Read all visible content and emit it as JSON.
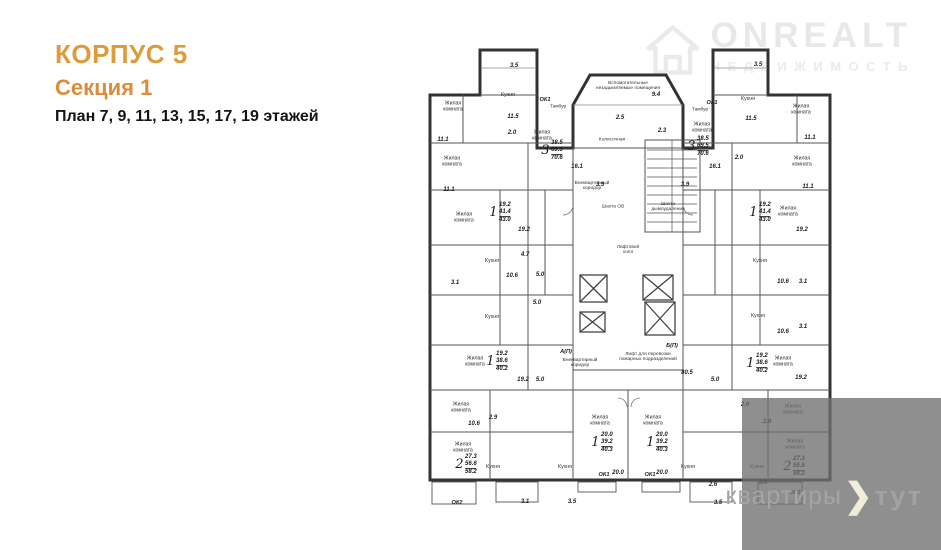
{
  "title": {
    "line1": "КОРПУС 5",
    "line2": "Секция 1",
    "line3": "План 7, 9, 11, 13, 15, 17, 19 этажей"
  },
  "watermark_top": {
    "brand": "ONREALT",
    "sub": "НЕДВИЖИМОСТЬ"
  },
  "watermark_bottom": {
    "word1": "квартиры",
    "word2": "тут"
  },
  "colors": {
    "title_orange": "#DD9B3B",
    "subtitle_orange": "#DC8C3A",
    "wall_dark": "#333333",
    "watermark_gray": "#d6d6d6",
    "box_gray": "#707070",
    "chevron_cream": "#F2ECDA"
  },
  "plan": {
    "labels": [
      {
        "t": "Жилая\nкомната",
        "x": 453,
        "y": 107,
        "s": "r"
      },
      {
        "t": "Жилая\nкомната",
        "x": 452,
        "y": 162,
        "s": "r"
      },
      {
        "t": "Жилая\nкомната",
        "x": 464,
        "y": 218,
        "s": "r"
      },
      {
        "t": "Жилая\nкомната",
        "x": 475,
        "y": 362,
        "s": "r"
      },
      {
        "t": "Жилая\nкомната",
        "x": 461,
        "y": 408,
        "s": "r"
      },
      {
        "t": "Жилая\nкомната",
        "x": 463,
        "y": 448,
        "s": "r"
      },
      {
        "t": "Жилая\nкомната",
        "x": 542,
        "y": 136,
        "s": "r"
      },
      {
        "t": "Жилая\nкомната",
        "x": 600,
        "y": 421,
        "s": "r"
      },
      {
        "t": "Жилая\nкомната",
        "x": 653,
        "y": 421,
        "s": "r"
      },
      {
        "t": "Жилая\nкомната",
        "x": 702,
        "y": 128,
        "s": "r"
      },
      {
        "t": "Жилая\nкомната",
        "x": 788,
        "y": 212,
        "s": "r"
      },
      {
        "t": "Жилая\nкомната",
        "x": 783,
        "y": 362,
        "s": "r"
      },
      {
        "t": "Жилая\nкомната",
        "x": 793,
        "y": 410,
        "s": "r"
      },
      {
        "t": "Жилая\nкомната",
        "x": 795,
        "y": 445,
        "s": "r"
      },
      {
        "t": "Жилая\nкомната",
        "x": 801,
        "y": 110,
        "s": "r"
      },
      {
        "t": "Жилая\nкомната",
        "x": 802,
        "y": 162,
        "s": "r"
      },
      {
        "t": "Кухня",
        "x": 508,
        "y": 96,
        "s": "k"
      },
      {
        "t": "Кухня",
        "x": 748,
        "y": 100,
        "s": "k"
      },
      {
        "t": "Кухня",
        "x": 492,
        "y": 262,
        "s": "k"
      },
      {
        "t": "Кухня",
        "x": 760,
        "y": 262,
        "s": "k"
      },
      {
        "t": "Кухня",
        "x": 492,
        "y": 318,
        "s": "k"
      },
      {
        "t": "Кухня",
        "x": 758,
        "y": 317,
        "s": "k"
      },
      {
        "t": "Кухня",
        "x": 493,
        "y": 468,
        "s": "k"
      },
      {
        "t": "Кухня",
        "x": 565,
        "y": 468,
        "s": "k"
      },
      {
        "t": "Кухня",
        "x": 688,
        "y": 468,
        "s": "k"
      },
      {
        "t": "Кухня",
        "x": 757,
        "y": 468,
        "s": "k"
      },
      {
        "t": "Тамбур",
        "x": 558,
        "y": 107,
        "s": "t"
      },
      {
        "t": "Тамбур",
        "x": 700,
        "y": 110,
        "s": "t"
      },
      {
        "t": "Колясочная",
        "x": 612,
        "y": 140,
        "s": "t"
      },
      {
        "t": "Внеквартирный\nкоридор",
        "x": 592,
        "y": 186,
        "s": "t"
      },
      {
        "t": "Внеквартирный\nкоридор",
        "x": 580,
        "y": 363,
        "s": "t"
      },
      {
        "t": "Лифтовой\nхолл",
        "x": 628,
        "y": 250,
        "s": "t"
      },
      {
        "t": "Шахта ОВ",
        "x": 613,
        "y": 207,
        "s": "t"
      },
      {
        "t": "Шахта\nдымоудаления",
        "x": 668,
        "y": 207,
        "s": "t"
      },
      {
        "t": "Вспомогательные\nнезадымляемые помещения",
        "x": 628,
        "y": 86,
        "s": "t"
      },
      {
        "t": "Лифт для перевозки\nпожарных подразделений",
        "x": 648,
        "y": 357,
        "s": "t"
      },
      {
        "t": "А(П)",
        "x": 566,
        "y": 352,
        "s": "ok"
      },
      {
        "t": "Б(П)",
        "x": 672,
        "y": 346,
        "s": "ok"
      },
      {
        "t": "ОК1",
        "x": 545,
        "y": 100,
        "s": "ok"
      },
      {
        "t": "ОК1",
        "x": 712,
        "y": 103,
        "s": "ok"
      },
      {
        "t": "ОК1",
        "x": 604,
        "y": 475,
        "s": "ok"
      },
      {
        "t": "ОК1",
        "x": 650,
        "y": 475,
        "s": "ok"
      },
      {
        "t": "ОК2",
        "x": 457,
        "y": 503,
        "s": "ok"
      },
      {
        "t": "ОК2",
        "x": 795,
        "y": 493,
        "s": "ok"
      },
      {
        "t": "11.1",
        "x": 443,
        "y": 140,
        "s": "a"
      },
      {
        "t": "11.1",
        "x": 449,
        "y": 190,
        "s": "a"
      },
      {
        "t": "11.5",
        "x": 513,
        "y": 117,
        "s": "a"
      },
      {
        "t": "3.5",
        "x": 514,
        "y": 66,
        "s": "a"
      },
      {
        "t": "3.5",
        "x": 758,
        "y": 65,
        "s": "a"
      },
      {
        "t": "11.5",
        "x": 751,
        "y": 119,
        "s": "a"
      },
      {
        "t": "2.0",
        "x": 512,
        "y": 133,
        "s": "a"
      },
      {
        "t": "2.0",
        "x": 739,
        "y": 158,
        "s": "a"
      },
      {
        "t": "9.4",
        "x": 656,
        "y": 95,
        "s": "a"
      },
      {
        "t": "2.5",
        "x": 620,
        "y": 118,
        "s": "a"
      },
      {
        "t": "2.3",
        "x": 662,
        "y": 131,
        "s": "a"
      },
      {
        "t": "16.1",
        "x": 577,
        "y": 167,
        "s": "a"
      },
      {
        "t": "16.1",
        "x": 715,
        "y": 167,
        "s": "a"
      },
      {
        "t": "3.9",
        "x": 600,
        "y": 185,
        "s": "a"
      },
      {
        "t": "3.9",
        "x": 685,
        "y": 185,
        "s": "a"
      },
      {
        "t": "19.2",
        "x": 524,
        "y": 230,
        "s": "a"
      },
      {
        "t": "19.2",
        "x": 802,
        "y": 230,
        "s": "a"
      },
      {
        "t": "19.2",
        "x": 523,
        "y": 380,
        "s": "a"
      },
      {
        "t": "19.2",
        "x": 801,
        "y": 378,
        "s": "a"
      },
      {
        "t": "10.6",
        "x": 512,
        "y": 276,
        "s": "a"
      },
      {
        "t": "10.6",
        "x": 783,
        "y": 282,
        "s": "a"
      },
      {
        "t": "10.6",
        "x": 474,
        "y": 424,
        "s": "a"
      },
      {
        "t": "10.6",
        "x": 783,
        "y": 332,
        "s": "a"
      },
      {
        "t": "4.7",
        "x": 525,
        "y": 255,
        "s": "a"
      },
      {
        "t": "5.0",
        "x": 540,
        "y": 275,
        "s": "a"
      },
      {
        "t": "5.0",
        "x": 537,
        "y": 303,
        "s": "a"
      },
      {
        "t": "5.0",
        "x": 540,
        "y": 380,
        "s": "a"
      },
      {
        "t": "5.0",
        "x": 715,
        "y": 380,
        "s": "a"
      },
      {
        "t": "3.1",
        "x": 455,
        "y": 283,
        "s": "a"
      },
      {
        "t": "3.1",
        "x": 803,
        "y": 282,
        "s": "a"
      },
      {
        "t": "3.1",
        "x": 803,
        "y": 327,
        "s": "a"
      },
      {
        "t": "11.1",
        "x": 810,
        "y": 138,
        "s": "a"
      },
      {
        "t": "11.1",
        "x": 808,
        "y": 187,
        "s": "a"
      },
      {
        "t": "2.9",
        "x": 493,
        "y": 418,
        "s": "a"
      },
      {
        "t": "2.9",
        "x": 767,
        "y": 422,
        "s": "a"
      },
      {
        "t": "2.6",
        "x": 745,
        "y": 405,
        "s": "a"
      },
      {
        "t": "2.6",
        "x": 713,
        "y": 485,
        "s": "a"
      },
      {
        "t": "3.6",
        "x": 763,
        "y": 483,
        "s": "a"
      },
      {
        "t": "80.5",
        "x": 687,
        "y": 373,
        "s": "a"
      },
      {
        "t": "20.0",
        "x": 618,
        "y": 473,
        "s": "a"
      },
      {
        "t": "20.0",
        "x": 662,
        "y": 473,
        "s": "a"
      },
      {
        "t": "3.1",
        "x": 525,
        "y": 502,
        "s": "a"
      },
      {
        "t": "3.5",
        "x": 572,
        "y": 502,
        "s": "a"
      },
      {
        "t": "3.5",
        "x": 718,
        "y": 503,
        "s": "a"
      }
    ],
    "stamps": [
      {
        "x": 552,
        "y": 151,
        "n": "3",
        "living": "38.5",
        "area": "69.5",
        "total": "70.6"
      },
      {
        "x": 698,
        "y": 147,
        "n": "3",
        "living": "38.5",
        "area": "69.5",
        "total": "70.6"
      },
      {
        "x": 500,
        "y": 213,
        "n": "1",
        "living": "19.2",
        "area": "41.4",
        "total": "43.0"
      },
      {
        "x": 760,
        "y": 213,
        "n": "1",
        "living": "19.2",
        "area": "41.4",
        "total": "43.0"
      },
      {
        "x": 497,
        "y": 362,
        "n": "1",
        "living": "19.2",
        "area": "38.6",
        "total": "40.2"
      },
      {
        "x": 757,
        "y": 364,
        "n": "1",
        "living": "19.2",
        "area": "38.6",
        "total": "40.2"
      },
      {
        "x": 466,
        "y": 465,
        "n": "2",
        "living": "27.3",
        "area": "56.6",
        "total": "58.2"
      },
      {
        "x": 794,
        "y": 467,
        "n": "2",
        "living": "27.3",
        "area": "56.6",
        "total": "58.2"
      },
      {
        "x": 602,
        "y": 443,
        "n": "1",
        "living": "20.0",
        "area": "39.2",
        "total": "40.3"
      },
      {
        "x": 657,
        "y": 443,
        "n": "1",
        "living": "20.0",
        "area": "39.2",
        "total": "40.3"
      }
    ]
  }
}
